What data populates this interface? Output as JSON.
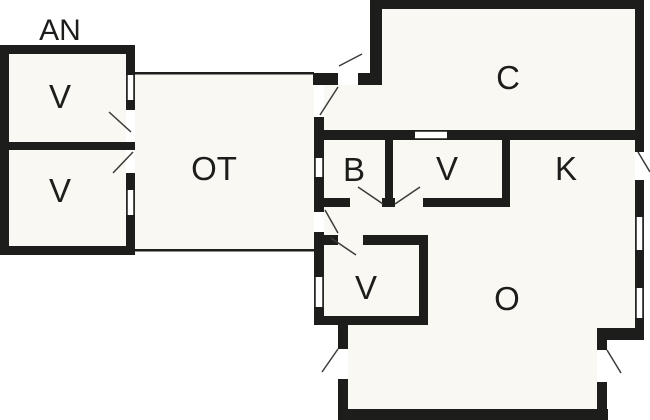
{
  "canvas": {
    "width": 650,
    "height": 420,
    "background_color": "#ffffff",
    "room_fill_color": "#f9f8f2",
    "wall_color": "#1d1d1b",
    "swing_line_color": "#3c3c3a",
    "label_color": "#1d1d1b"
  },
  "floorplan": {
    "fills": [
      {
        "type": "rect",
        "x": 9,
        "y": 54,
        "w": 117,
        "h": 192
      },
      {
        "type": "rect",
        "x": 135,
        "y": 74,
        "w": 179,
        "h": 175
      },
      {
        "type": "poly",
        "points": "324,85 382,85 382,9 635,9 635,328 597,328 597,410 348,410 348,325 324,325"
      }
    ],
    "walls": [
      {
        "x": 0,
        "y": 45,
        "w": 135,
        "h": 9
      },
      {
        "x": 0,
        "y": 45,
        "w": 9,
        "h": 210
      },
      {
        "x": 0,
        "y": 246,
        "w": 135,
        "h": 9
      },
      {
        "x": 0,
        "y": 142,
        "w": 135,
        "h": 8
      },
      {
        "x": 126,
        "y": 45,
        "w": 9,
        "h": 30
      },
      {
        "x": 126,
        "y": 100,
        "w": 9,
        "h": 10
      },
      {
        "x": 126,
        "y": 173,
        "w": 9,
        "h": 17
      },
      {
        "x": 126,
        "y": 215,
        "w": 9,
        "h": 40
      },
      {
        "x": 313,
        "y": 73,
        "w": 25,
        "h": 12
      },
      {
        "x": 358,
        "y": 73,
        "w": 24,
        "h": 12
      },
      {
        "x": 370,
        "y": 0,
        "w": 274,
        "h": 9
      },
      {
        "x": 370,
        "y": 0,
        "w": 12,
        "h": 85
      },
      {
        "x": 635,
        "y": 0,
        "w": 9,
        "h": 152
      },
      {
        "x": 635,
        "y": 180,
        "w": 9,
        "h": 37
      },
      {
        "x": 635,
        "y": 250,
        "w": 9,
        "h": 38
      },
      {
        "x": 635,
        "y": 318,
        "w": 9,
        "h": 22
      },
      {
        "x": 314,
        "y": 130,
        "w": 330,
        "h": 10
      },
      {
        "x": 314,
        "y": 117,
        "w": 10,
        "h": 41
      },
      {
        "x": 314,
        "y": 177,
        "w": 10,
        "h": 35
      },
      {
        "x": 314,
        "y": 232,
        "w": 10,
        "h": 45
      },
      {
        "x": 314,
        "y": 307,
        "w": 10,
        "h": 18
      },
      {
        "x": 385,
        "y": 140,
        "w": 8,
        "h": 60
      },
      {
        "x": 314,
        "y": 198,
        "w": 36,
        "h": 9
      },
      {
        "x": 382,
        "y": 198,
        "w": 13,
        "h": 9
      },
      {
        "x": 423,
        "y": 198,
        "w": 87,
        "h": 9
      },
      {
        "x": 502,
        "y": 140,
        "w": 8,
        "h": 67
      },
      {
        "x": 322,
        "y": 235,
        "w": 16,
        "h": 10
      },
      {
        "x": 363,
        "y": 235,
        "w": 65,
        "h": 10
      },
      {
        "x": 419,
        "y": 235,
        "w": 9,
        "h": 90
      },
      {
        "x": 314,
        "y": 316,
        "w": 114,
        "h": 9
      },
      {
        "x": 338,
        "y": 325,
        "w": 10,
        "h": 24
      },
      {
        "x": 338,
        "y": 379,
        "w": 10,
        "h": 31
      },
      {
        "x": 338,
        "y": 409,
        "w": 270,
        "h": 11
      },
      {
        "x": 597,
        "y": 382,
        "w": 10,
        "h": 28
      },
      {
        "x": 597,
        "y": 328,
        "w": 47,
        "h": 12
      },
      {
        "x": 597,
        "y": 328,
        "w": 10,
        "h": 22
      }
    ],
    "thin_lines": [
      {
        "x": 135,
        "y": 72,
        "w": 179,
        "h": 2.5
      },
      {
        "x": 135,
        "y": 249,
        "w": 179,
        "h": 2.5
      }
    ],
    "windows": [
      {
        "x": 126,
        "y": 75,
        "w": 9,
        "h": 25,
        "o": "v"
      },
      {
        "x": 126,
        "y": 190,
        "w": 9,
        "h": 25,
        "o": "v"
      },
      {
        "x": 314,
        "y": 158,
        "w": 10,
        "h": 19,
        "o": "v"
      },
      {
        "x": 314,
        "y": 277,
        "w": 10,
        "h": 30,
        "o": "v"
      },
      {
        "x": 635,
        "y": 217,
        "w": 9,
        "h": 33,
        "o": "v"
      },
      {
        "x": 635,
        "y": 288,
        "w": 9,
        "h": 30,
        "o": "v"
      },
      {
        "x": 415,
        "y": 130,
        "w": 32,
        "h": 10,
        "o": "h"
      }
    ],
    "door_swings": [
      {
        "x1": 339,
        "y1": 66,
        "x2": 362,
        "y2": 54
      },
      {
        "x1": 320,
        "y1": 115,
        "x2": 338,
        "y2": 87
      },
      {
        "x1": 325,
        "y1": 210,
        "x2": 338,
        "y2": 233
      },
      {
        "x1": 331,
        "y1": 238,
        "x2": 356,
        "y2": 255
      },
      {
        "x1": 358,
        "y1": 187,
        "x2": 383,
        "y2": 204
      },
      {
        "x1": 420,
        "y1": 187,
        "x2": 395,
        "y2": 204
      },
      {
        "x1": 638,
        "y1": 152,
        "x2": 650,
        "y2": 172
      },
      {
        "x1": 338,
        "y1": 349,
        "x2": 322,
        "y2": 372
      },
      {
        "x1": 607,
        "y1": 350,
        "x2": 621,
        "y2": 373
      },
      {
        "x1": 109,
        "y1": 112,
        "x2": 131,
        "y2": 132
      },
      {
        "x1": 113,
        "y1": 173,
        "x2": 133,
        "y2": 152
      }
    ],
    "labels": [
      {
        "text": "AN",
        "x": 60,
        "y": 29,
        "size": 30
      },
      {
        "text": "V",
        "x": 60,
        "y": 96,
        "size": 33
      },
      {
        "text": "V",
        "x": 60,
        "y": 190,
        "size": 33
      },
      {
        "text": "OT",
        "x": 214,
        "y": 168,
        "size": 33
      },
      {
        "text": "C",
        "x": 508,
        "y": 77,
        "size": 33
      },
      {
        "text": "B",
        "x": 354,
        "y": 169,
        "size": 33
      },
      {
        "text": "V",
        "x": 447,
        "y": 168,
        "size": 33
      },
      {
        "text": "K",
        "x": 566,
        "y": 168,
        "size": 33
      },
      {
        "text": "V",
        "x": 366,
        "y": 287,
        "size": 33
      },
      {
        "text": "O",
        "x": 507,
        "y": 298,
        "size": 33
      }
    ]
  }
}
